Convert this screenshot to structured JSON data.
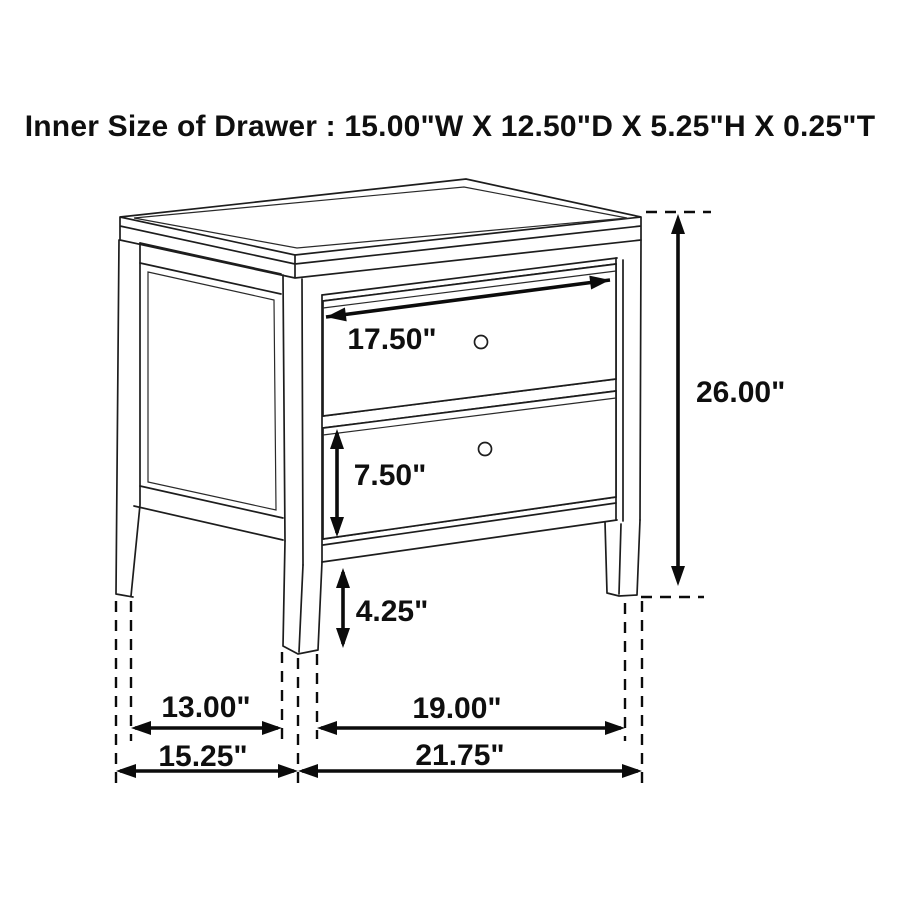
{
  "title": "Inner Size of Drawer : 15.00\"W X 12.50\"D X 5.25\"H X 0.25\"T",
  "colors": {
    "ink": "#0f0f0f",
    "paper": "#ffffff"
  },
  "dimensions": {
    "top_drawer_width": {
      "label": "17.50\""
    },
    "overall_height": {
      "label": "26.00\""
    },
    "bottom_drawer_height": {
      "label": "7.50\""
    },
    "leg_height": {
      "label": "4.25\""
    },
    "side_span_inner": {
      "label": "13.00\""
    },
    "front_span_inner": {
      "label": "19.00\""
    },
    "overall_depth": {
      "label": "15.25\""
    },
    "overall_width": {
      "label": "21.75\""
    }
  }
}
